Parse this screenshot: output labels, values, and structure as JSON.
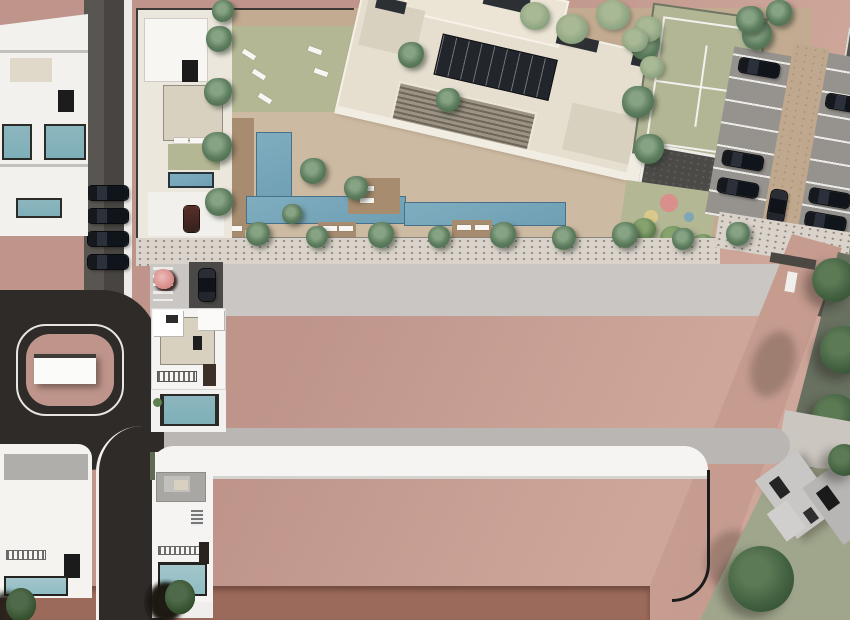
{
  "scene": {
    "title": "Aerial 3D render of a residential development master plan",
    "areas": [
      "apartment-building-with-rooftop-solar-panels",
      "communal-pool-and-sun-decks",
      "lawn-garden-with-sun-loungers",
      "tennis-court",
      "petanque-court",
      "children-playground",
      "parking-lot-with-cars",
      "middle-townhouse-row-with-private-pools",
      "bottom-townhouse-row-with-private-pools",
      "cul-de-sac-road-loop",
      "landscaped-terrain"
    ]
  },
  "colors": {
    "terrain": "#bf958b",
    "terrain-light": "#cfa79a",
    "asphalt": "#2e2b29",
    "street": "#c9c6c4",
    "sidewalk": "#d9d3cb",
    "paving-tan": "#c2ab90",
    "deck-pale": "#cdbaa2",
    "deck-wood": "#a78c6f",
    "lawn": "#b4b794",
    "pool-blue": "#6f9fb3",
    "pool-teal": "#7eafb9",
    "pool-teal2": "#8fbcc4",
    "cream": "#e6dfd0",
    "beige-tile": "#d9d1c0",
    "court-green": "#b2b694",
    "parking-gray": "#96938f",
    "parking-aisle": "#bfa88d",
    "villa-white": "#f5f4f2",
    "roof-gray": "#a9a7a4",
    "brick": "#9b6a5a",
    "green-zone": "#687060",
    "lawn-gray": "#9fa68c",
    "road-pink": "#cfa89c",
    "blossom": "#d98f8c",
    "palm": "#5d7d5f",
    "tree-light": "#8ea583",
    "wall-dark": "#3c3936"
  },
  "counts": {
    "middle_row_villas": 8,
    "bottom_row_villas": 9,
    "left_street_cars": 4,
    "bottom_edge_trees": 10,
    "bottom_left_trees": 3
  }
}
